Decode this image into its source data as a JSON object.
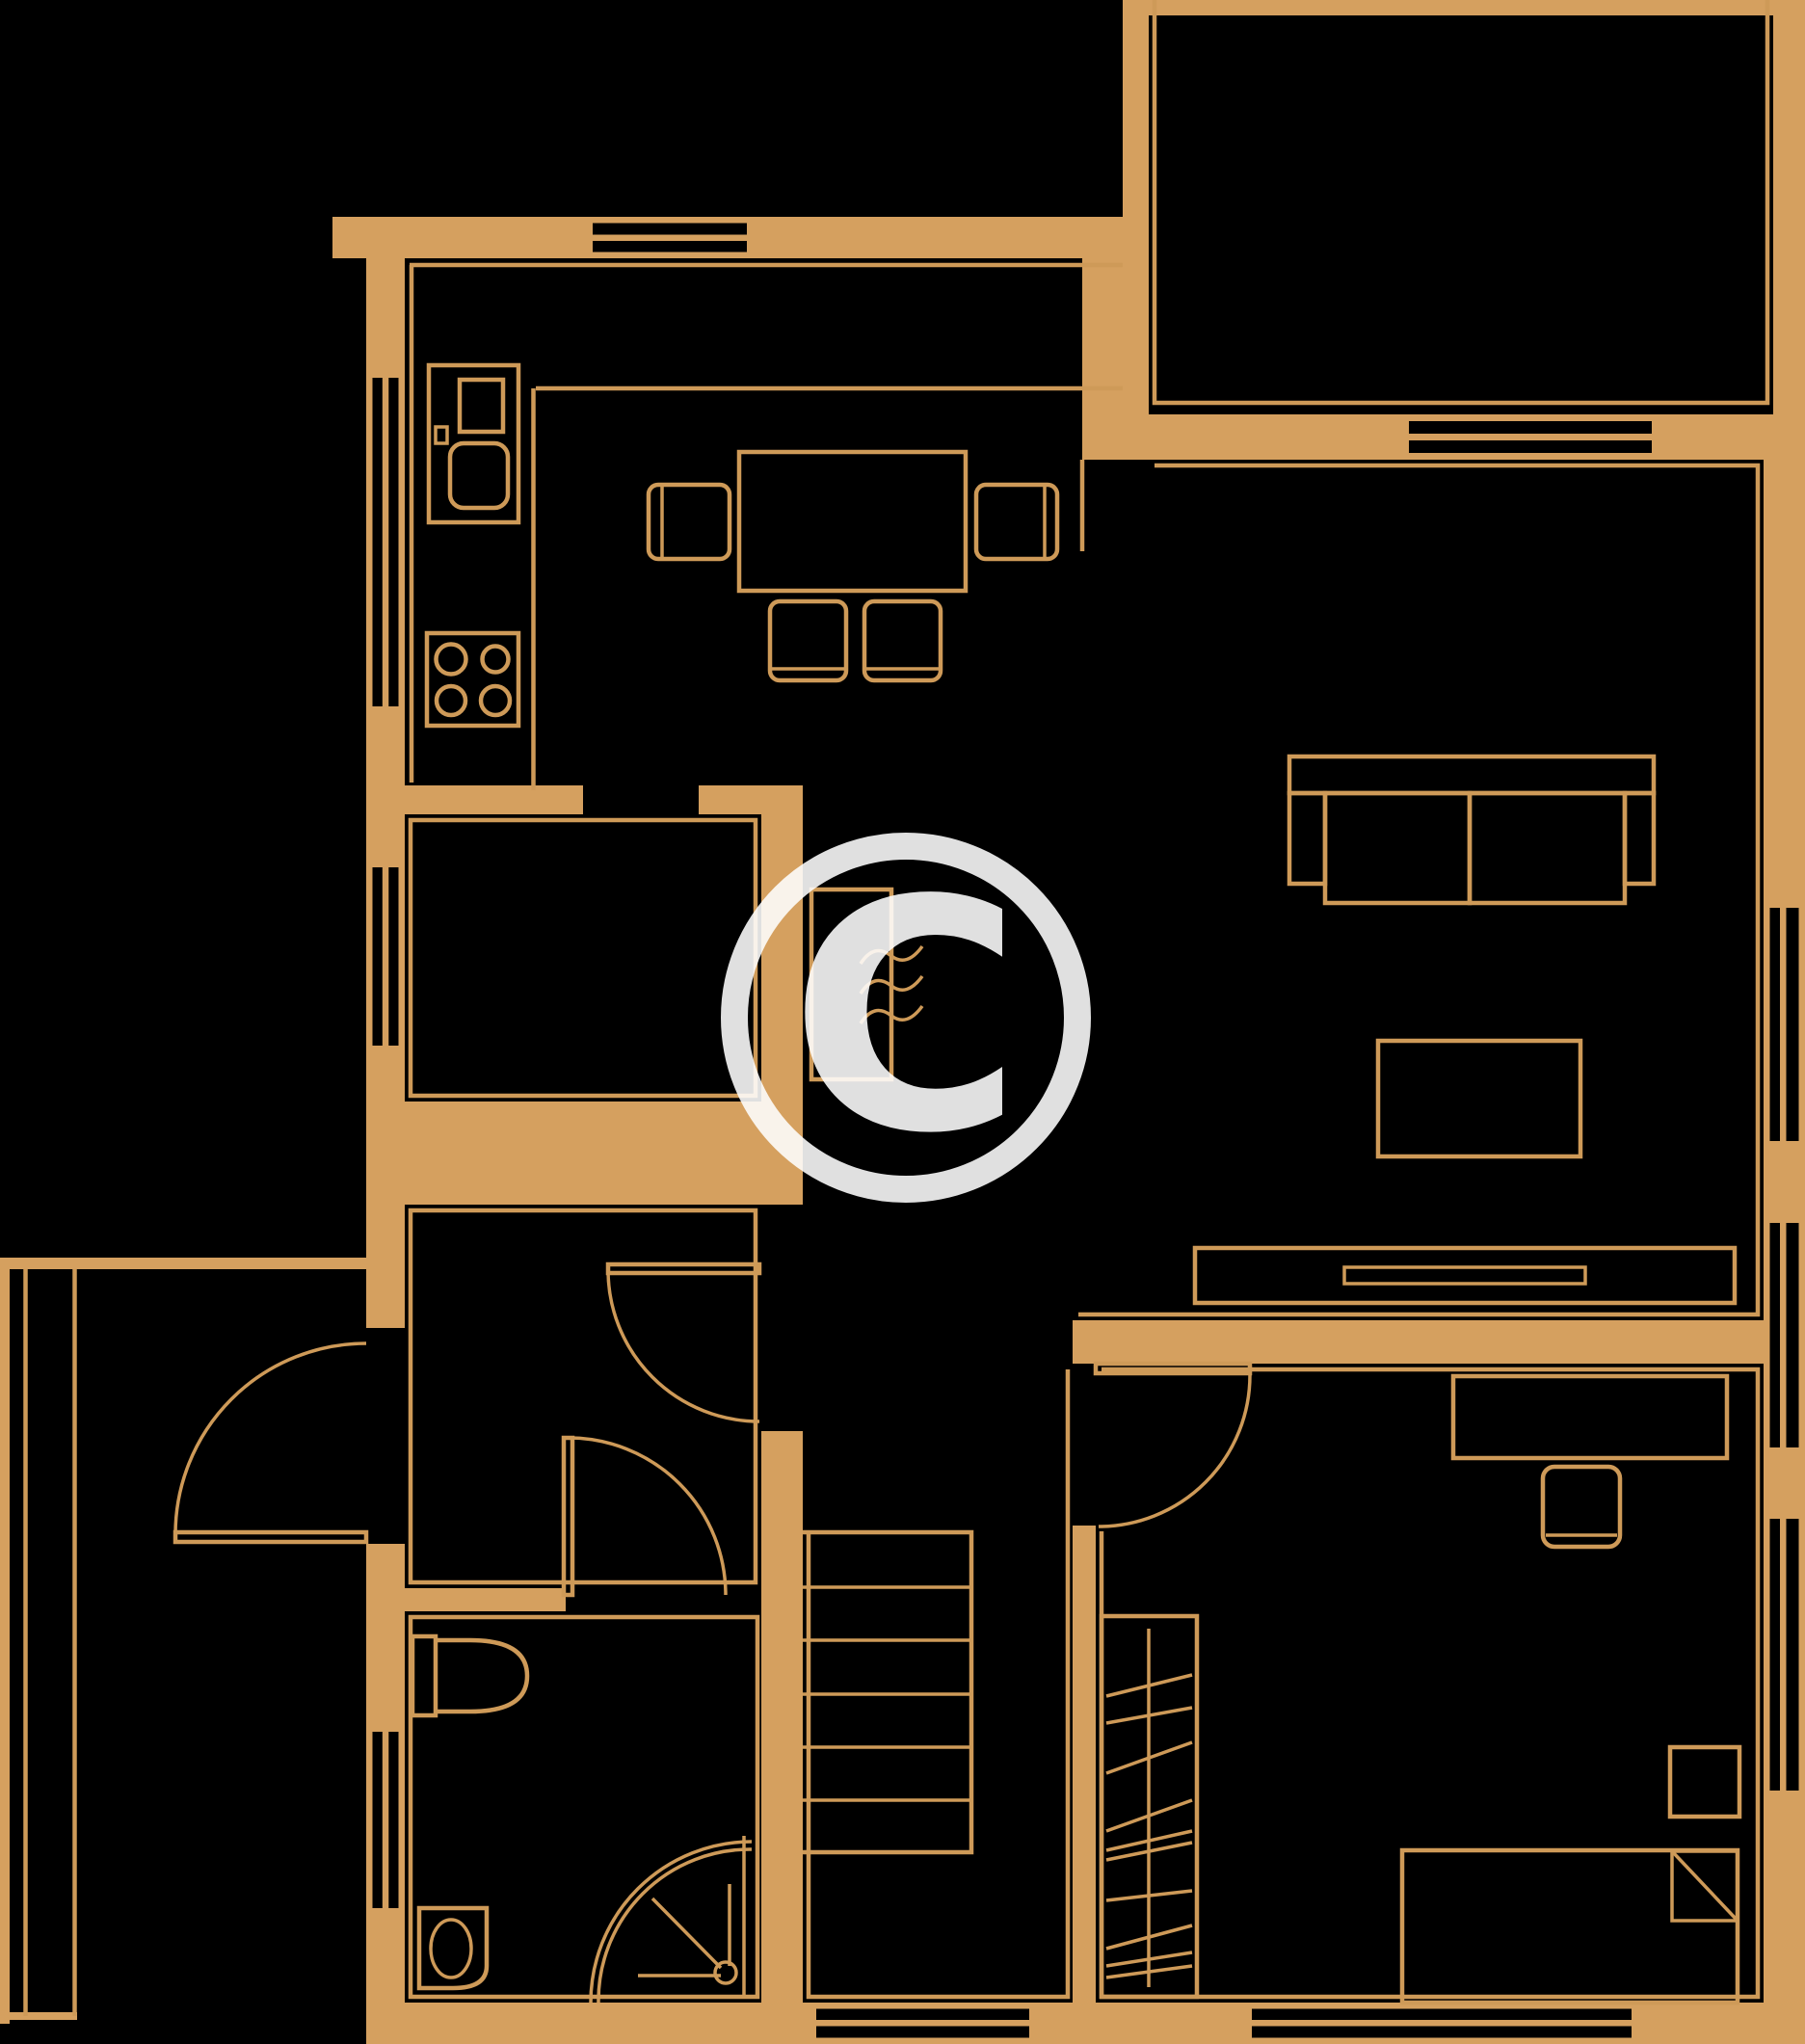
{
  "document": {
    "type": "floor-plan",
    "style": "line-drawing",
    "orientation": "top-down"
  },
  "colors": {
    "bg": "#000000",
    "wall": "#D5A05F",
    "line": "#CE9A58",
    "watermark": "#FFFFFF"
  },
  "watermark": {
    "symbol": "C",
    "shape": "circle-with-letter",
    "position": "center"
  },
  "elements": {
    "walls": "thick orange filled segments",
    "window_count": 9,
    "door_count": 4,
    "porch_glazing": "double line screen at far left",
    "furniture": [
      "kitchen-counter",
      "kitchen-sink-unit",
      "stove-4-burners",
      "dining-table",
      "dining-chair x4",
      "sofa",
      "coffee-table",
      "tv-console",
      "radiator",
      "desk",
      "desk-chair",
      "bedside-table",
      "bed-with-pillow",
      "wardrobe",
      "stairs",
      "toilet",
      "washbasin",
      "corner-shower"
    ]
  }
}
